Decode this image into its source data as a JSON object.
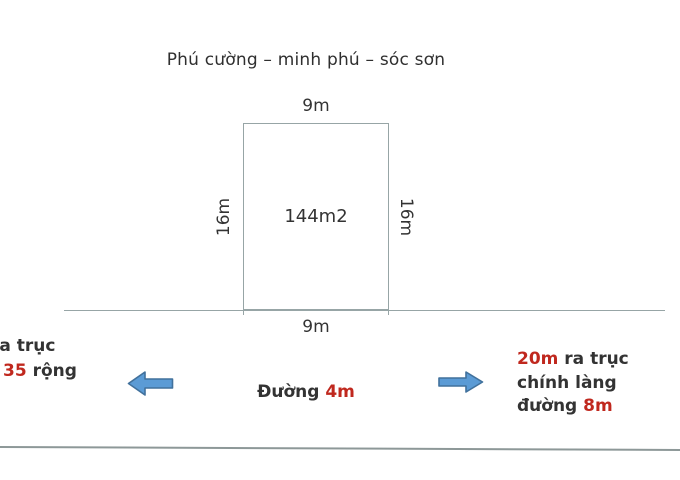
{
  "title": "Phú cường – minh phú – sóc sơn",
  "plot": {
    "area_label": "144m2",
    "width_top": "9m",
    "width_bottom": "9m",
    "height_left": "16m",
    "height_right": "16m"
  },
  "road": {
    "label_prefix": "Đường ",
    "label_value": "4m"
  },
  "left_note": {
    "line1": "ra trục",
    "line2_value": "35",
    "line2_rest": " rộng"
  },
  "right_note": {
    "line1_value": "20m",
    "line1_rest": " ra trục",
    "line2": "chính làng",
    "line3_prefix": "đường ",
    "line3_value": "8m"
  },
  "colors": {
    "text": "#333333",
    "accent_red": "#c0281e",
    "arrow_fill": "#5b9bd5",
    "arrow_stroke": "#41719c",
    "line": "#97a5a6"
  }
}
